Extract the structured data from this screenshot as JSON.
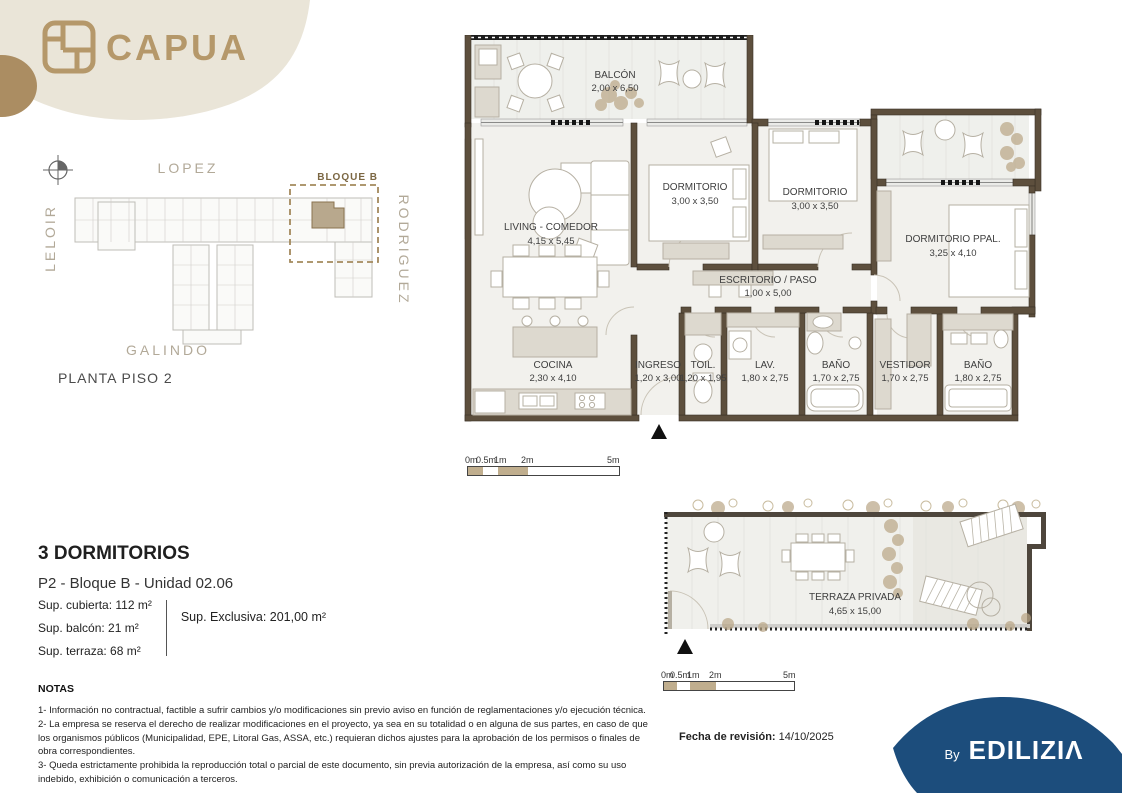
{
  "colors": {
    "accent": "#b5986a",
    "beige": "#eae5d8",
    "tan": "#ab8d62",
    "navy": "#1c4d7c",
    "wall": "#5d4f3d"
  },
  "header": {
    "brand": "CAPUA"
  },
  "site_plan": {
    "street_top": "LOPEZ",
    "street_left": "LELOIR",
    "street_right": "RODRIGUEZ",
    "street_bottom": "GALINDO",
    "block_label": "BLOQUE B",
    "caption": "PLANTA PISO 2"
  },
  "floor_plan": {
    "rooms": [
      {
        "name": "BALCÓN",
        "dims": "2,00 x 6,50"
      },
      {
        "name": "LIVING - COMEDOR",
        "dims": "4,15 x 5,45"
      },
      {
        "name": "DORMITORIO",
        "dims": "3,00 x 3,50"
      },
      {
        "name": "DORMITORIO",
        "dims": "3,00 x 3,50"
      },
      {
        "name": "DORMITORIO PPAL.",
        "dims": "3,25 x 4,10"
      },
      {
        "name": "ESCRITORIO / PASO",
        "dims": "1,00 x 5,00"
      },
      {
        "name": "COCINA",
        "dims": "2,30 x 4,10"
      },
      {
        "name": "INGRESO",
        "dims": "1,20 x 3,00"
      },
      {
        "name": "TOIL.",
        "dims": "1,20 x 1,95"
      },
      {
        "name": "LAV.",
        "dims": "1,80 x 2,75"
      },
      {
        "name": "BAÑO",
        "dims": "1,70 x 2,75"
      },
      {
        "name": "VESTIDOR",
        "dims": "1,70 x 2,75"
      },
      {
        "name": "BAÑO",
        "dims": "1,80 x 2,75"
      }
    ]
  },
  "terrace_plan": {
    "name": "TERRAZA PRIVADA",
    "dims": "4,65 x 15,00"
  },
  "scale_bar_main": {
    "labels": [
      "0m",
      "0.5m",
      "1m",
      "2m",
      "5m"
    ]
  },
  "scale_bar_terrace": {
    "labels": [
      "0m",
      "0.5m",
      "1m",
      "2m",
      "5m"
    ]
  },
  "unit_info": {
    "title": "3 DORMITORIOS",
    "subtitle": "P2 - Bloque B - Unidad 02.06",
    "areas": [
      "Sup. cubierta: 112 m²",
      "Sup. balcón: 21 m²",
      "Sup. terraza: 68 m²"
    ],
    "exclusive": "Sup. Exclusiva: 201,00 m²"
  },
  "notes": {
    "title": "NOTAS",
    "items": [
      "1- Información no contractual, factible a sufrir cambios y/o modificaciones sin previo aviso en función de reglamentaciones y/o ejecución técnica.",
      "2- La empresa se reserva el derecho de realizar modificaciones en el proyecto, ya sea en su totalidad o en alguna de sus partes, en caso de que los organismos públicos (Municipalidad, EPE, Litoral Gas, ASSA, etc.) requieran dichos ajustes para la aprobación de los permisos o finales de obra correspondientes.",
      "3- Queda estrictamente prohibida la reproducción total o parcial de este documento, sin previa autorización de la empresa, así como su uso indebido, exhibición o comunicación a terceros."
    ]
  },
  "footer": {
    "revision_label": "Fecha de revisión:",
    "revision_date": "14/10/2025",
    "by": "By",
    "brand": "EDILIZIΛ"
  }
}
